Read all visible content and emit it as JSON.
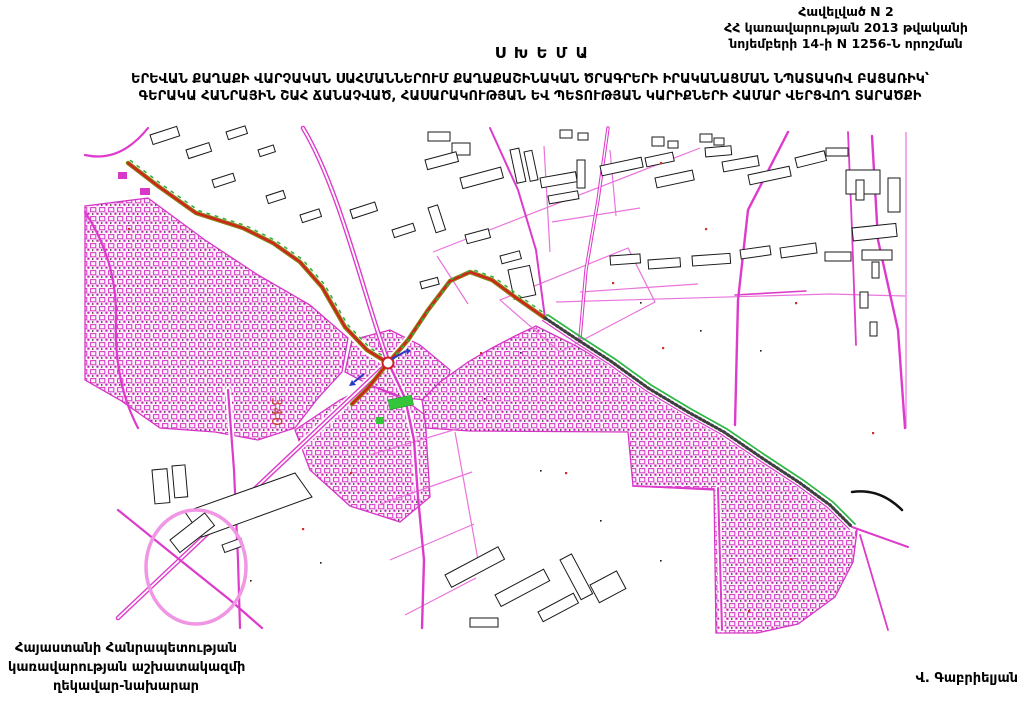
{
  "header": {
    "annex_line1": "Հավելված N 2",
    "annex_line2": "ՀՀ կառավարության 2013 թվականի",
    "annex_line3": "նոյեմբերի 14-ի N 1256-Ն որոշման"
  },
  "title": "Ս Խ Ե Մ Ա",
  "subtitle": {
    "line1": "ԵՐԵՎԱՆ ՔԱՂԱՔԻ ՎԱՐՉԱԿԱՆ ՍԱՀՄԱՆՆԵՐՈՒՄ ՔԱՂԱՔԱՇԻՆԱԿԱՆ ԾՐԱԳՐԵՐԻ ԻՐԱԿԱՆԱՑՄԱՆ ՆՊԱՏԱԿՈՎ ԲԱՑԱՌԻԿ՝",
    "line2": "ԳԵՐԱԿԱ ՀԱՆՐԱՅԻՆ ՇԱՀ ՃԱՆԱՉՎԱԾ, ՀԱՍԱՐԱԿՈՒԹՅԱՆ ԵՎ ՊԵՏՈՒԹՅԱՆ ԿԱՐԻՔՆԵՐԻ ՀԱՄԱՐ ՎԵՐՑՎՈՂ ՏԱՐԱԾՔԻ"
  },
  "map": {
    "parcel_label": "340",
    "colors": {
      "parcel_lines": "#e23bd0",
      "dense_urban": "#cc2ab8",
      "highlighted_route": "#d41f1f",
      "route_casing": "#8f7d12",
      "green_line": "#2db845",
      "buildings": "#1a1a1a"
    }
  },
  "footer": {
    "left_line1": "Հայաստանի Հանրապետության",
    "left_line2": "կառավարության աշխատակազմի",
    "left_line3": "ղեկավար-նախարար",
    "signature": "Վ. Գաբրիելյան"
  }
}
